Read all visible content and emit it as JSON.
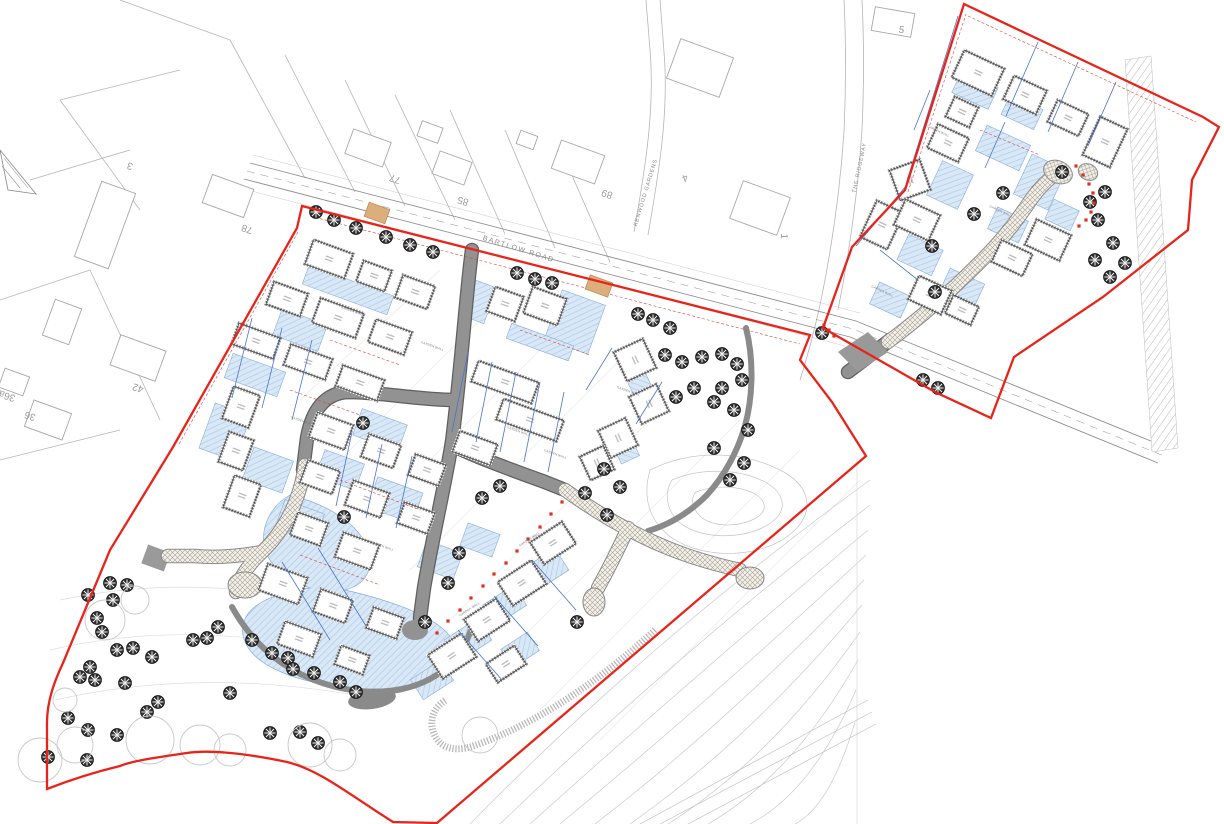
{
  "map": {
    "colors": {
      "site_boundary_red": "#e8231a",
      "inner_dash_red": "#d04545",
      "road_fill_grey": "#929292",
      "road_edge_grey": "#5f5f5f",
      "shared_surface_bg": "#f3f1ea",
      "shared_surface_hatch": "#a8a294",
      "drive_fill_blue": "#d9e8f7",
      "drive_hatch_blue": "#a9c6e6",
      "plot_line_blue": "#4a74cc",
      "building_wall_grey": "#8a8a8a",
      "context_line_grey": "#a8a8a8",
      "contour_grey": "#cacaca",
      "tree_dark": "#2e2e2e",
      "crossing_tan": "#dcae7e",
      "marker_dot_red": "#e03020"
    },
    "road_labels": [
      {
        "text": "BARTLOW ROAD",
        "x": 518,
        "y": 251,
        "rot": 17.5,
        "size": 7,
        "ls": 1.5
      },
      {
        "text": "KENWOOD GARDENS",
        "x": 647,
        "y": 193,
        "rot": -73,
        "size": 5.5,
        "ls": 0.8
      },
      {
        "text": "THE RIDGEWAY",
        "x": 861,
        "y": 168,
        "rot": -78,
        "size": 5.5,
        "ls": 0.8
      }
    ],
    "house_numbers": [
      {
        "text": "77",
        "x": 396,
        "y": 176,
        "rot": 198
      },
      {
        "text": "85",
        "x": 464,
        "y": 198,
        "rot": 198
      },
      {
        "text": "89",
        "x": 608,
        "y": 191,
        "rot": 198
      },
      {
        "text": "4",
        "x": 684,
        "y": 175,
        "rot": 160
      },
      {
        "text": "1",
        "x": 781,
        "y": 236,
        "rot": 95
      },
      {
        "text": "78",
        "x": 248,
        "y": 226,
        "rot": 198
      },
      {
        "text": "42",
        "x": 139,
        "y": 385,
        "rot": 198
      },
      {
        "text": "36a",
        "x": 8,
        "y": 393,
        "rot": 198
      },
      {
        "text": "36",
        "x": 31,
        "y": 413,
        "rot": 198
      },
      {
        "text": "5",
        "x": 901,
        "y": 33,
        "rot": 10
      },
      {
        "text": "3",
        "x": 131,
        "y": 163,
        "rot": 198
      }
    ],
    "annotation_labels": [
      {
        "text": "GARDEN WALL",
        "x": 352,
        "y": 312,
        "rot": 20
      },
      {
        "text": "GARDEN WALL",
        "x": 432,
        "y": 347,
        "rot": 20
      },
      {
        "text": "GARDEN WALL",
        "x": 518,
        "y": 432,
        "rot": 20
      },
      {
        "text": "GARDEN WALL",
        "x": 302,
        "y": 422,
        "rot": 20
      },
      {
        "text": "GARDEN WALL",
        "x": 382,
        "y": 547,
        "rot": 20
      },
      {
        "text": "GARDEN WALL",
        "x": 555,
        "y": 455,
        "rot": 20
      },
      {
        "text": "GARDEN WALL",
        "x": 938,
        "y": 132,
        "rot": 25
      },
      {
        "text": "GARDEN WALL",
        "x": 1000,
        "y": 212,
        "rot": 25
      },
      {
        "text": "GARDEN WALL",
        "x": 882,
        "y": 292,
        "rot": 25
      },
      {
        "text": "GARDEN WALL",
        "x": 628,
        "y": 392,
        "rot": 20
      },
      {
        "text": "GARDEN WALL",
        "x": 470,
        "y": 610,
        "rot": -33
      },
      {
        "text": "GARDEN WALL",
        "x": 530,
        "y": 540,
        "rot": -33
      }
    ],
    "buildings": [
      [
        329,
        259,
        42,
        26,
        20
      ],
      [
        374,
        276,
        30,
        22,
        20
      ],
      [
        415,
        292,
        34,
        24,
        20
      ],
      [
        287,
        299,
        36,
        24,
        20
      ],
      [
        338,
        318,
        46,
        26,
        20
      ],
      [
        390,
        337,
        38,
        24,
        20
      ],
      [
        256,
        341,
        44,
        22,
        20
      ],
      [
        308,
        362,
        44,
        22,
        20
      ],
      [
        360,
        383,
        44,
        22,
        20
      ],
      [
        241,
        407,
        28,
        34,
        20
      ],
      [
        236,
        451,
        26,
        32,
        20
      ],
      [
        242,
        496,
        28,
        34,
        20
      ],
      [
        331,
        431,
        38,
        26,
        20
      ],
      [
        381,
        451,
        34,
        24,
        20
      ],
      [
        427,
        470,
        32,
        22,
        20
      ],
      [
        320,
        477,
        34,
        24,
        20
      ],
      [
        367,
        499,
        38,
        26,
        20
      ],
      [
        416,
        518,
        32,
        22,
        20
      ],
      [
        309,
        529,
        32,
        24,
        20
      ],
      [
        357,
        551,
        38,
        26,
        20
      ],
      [
        283,
        584,
        42,
        28,
        20
      ],
      [
        333,
        606,
        34,
        24,
        20
      ],
      [
        385,
        623,
        32,
        22,
        20
      ],
      [
        299,
        639,
        38,
        24,
        20
      ],
      [
        352,
        660,
        30,
        20,
        20
      ],
      [
        505,
        304,
        30,
        26,
        20
      ],
      [
        545,
        306,
        36,
        28,
        20
      ],
      [
        505,
        382,
        64,
        22,
        20
      ],
      [
        530,
        420,
        64,
        22,
        20
      ],
      [
        475,
        448,
        40,
        22,
        20
      ],
      [
        635,
        360,
        32,
        32,
        65
      ],
      [
        649,
        404,
        30,
        30,
        65
      ],
      [
        618,
        438,
        30,
        30,
        65
      ],
      [
        597,
        463,
        26,
        26,
        65
      ],
      [
        553,
        543,
        38,
        26,
        -33
      ],
      [
        522,
        583,
        40,
        28,
        -33
      ],
      [
        487,
        620,
        38,
        26,
        -33
      ],
      [
        452,
        656,
        40,
        28,
        -33
      ],
      [
        506,
        664,
        34,
        22,
        -33
      ],
      [
        978,
        73,
        44,
        30,
        25
      ],
      [
        1025,
        95,
        36,
        26,
        25
      ],
      [
        1068,
        118,
        34,
        24,
        25
      ],
      [
        1105,
        142,
        30,
        42,
        25
      ],
      [
        962,
        112,
        26,
        22,
        25
      ],
      [
        948,
        143,
        34,
        26,
        25
      ],
      [
        910,
        180,
        32,
        32,
        70
      ],
      [
        882,
        225,
        30,
        40,
        25
      ],
      [
        917,
        220,
        38,
        28,
        25
      ],
      [
        1048,
        240,
        38,
        28,
        25
      ],
      [
        1012,
        258,
        34,
        24,
        25
      ],
      [
        930,
        295,
        36,
        26,
        25
      ],
      [
        962,
        310,
        28,
        20,
        25
      ]
    ],
    "context_houses": [
      [
        368,
        148,
        40,
        26,
        20
      ],
      [
        430,
        132,
        22,
        16,
        20
      ],
      [
        452,
        168,
        34,
        24,
        20
      ],
      [
        578,
        162,
        46,
        30,
        20
      ],
      [
        527,
        140,
        18,
        14,
        20
      ],
      [
        700,
        68,
        56,
        42,
        20
      ],
      [
        760,
        208,
        50,
        40,
        20
      ],
      [
        893,
        22,
        40,
        24,
        10
      ],
      [
        228,
        196,
        44,
        30,
        20
      ],
      [
        138,
        358,
        48,
        32,
        20
      ],
      [
        48,
        420,
        40,
        28,
        20
      ],
      [
        14,
        382,
        26,
        20,
        20
      ],
      [
        105,
        225,
        36,
        80,
        20
      ],
      [
        62,
        322,
        28,
        38,
        20
      ]
    ],
    "driveways": [
      [
        348,
        290,
        90,
        20,
        20
      ],
      [
        575,
        322,
        46,
        52,
        20
      ],
      [
        480,
        302,
        22,
        38,
        20
      ],
      [
        540,
        342,
        66,
        16,
        20
      ],
      [
        300,
        330,
        48,
        28,
        20
      ],
      [
        255,
        375,
        56,
        26,
        20
      ],
      [
        225,
        432,
        38,
        48,
        20
      ],
      [
        268,
        470,
        42,
        34,
        20
      ],
      [
        380,
        430,
        48,
        28,
        20
      ],
      [
        340,
        470,
        42,
        28,
        20
      ],
      [
        395,
        500,
        48,
        32,
        20
      ],
      [
        300,
        520,
        42,
        28,
        20
      ],
      [
        440,
        560,
        38,
        28,
        20
      ],
      [
        480,
        540,
        34,
        24,
        20
      ],
      [
        545,
        570,
        40,
        26,
        -33
      ],
      [
        505,
        605,
        36,
        24,
        -33
      ],
      [
        468,
        640,
        40,
        26,
        -33
      ],
      [
        432,
        680,
        36,
        24,
        -33
      ],
      [
        520,
        650,
        32,
        22,
        -33
      ],
      [
        640,
        385,
        26,
        20,
        65
      ],
      [
        625,
        448,
        26,
        20,
        65
      ],
      [
        975,
        90,
        40,
        24,
        25
      ],
      [
        1022,
        112,
        36,
        22,
        25
      ],
      [
        1003,
        148,
        48,
        28,
        25
      ],
      [
        1040,
        182,
        38,
        44,
        25
      ],
      [
        950,
        185,
        34,
        38,
        25
      ],
      [
        920,
        255,
        38,
        28,
        25
      ],
      [
        1008,
        225,
        34,
        24,
        25
      ],
      [
        1062,
        215,
        28,
        22,
        25
      ],
      [
        890,
        300,
        34,
        24,
        25
      ],
      [
        962,
        288,
        38,
        26,
        25
      ]
    ],
    "plot_lines_blue": [
      [
        468,
        352,
        452,
        432
      ],
      [
        492,
        362,
        476,
        442
      ],
      [
        516,
        372,
        500,
        452
      ],
      [
        540,
        382,
        524,
        462
      ],
      [
        564,
        392,
        548,
        472
      ],
      [
        252,
        318,
        232,
        398
      ],
      [
        282,
        328,
        262,
        408
      ],
      [
        312,
        340,
        292,
        420
      ],
      [
        352,
        432,
        336,
        506
      ],
      [
        382,
        444,
        366,
        518
      ],
      [
        412,
        456,
        396,
        528
      ],
      [
        282,
        562,
        330,
        640
      ],
      [
        318,
        548,
        366,
        626
      ],
      [
        532,
        560,
        576,
        610
      ],
      [
        494,
        596,
        538,
        646
      ],
      [
        458,
        630,
        502,
        680
      ],
      [
        612,
        348,
        586,
        390
      ],
      [
        662,
        382,
        636,
        424
      ],
      [
        958,
        16,
        906,
        184
      ],
      [
        906,
        186,
        856,
        246
      ],
      [
        1038,
        42,
        1006,
        116
      ],
      [
        1078,
        62,
        1048,
        132
      ],
      [
        1116,
        82,
        1088,
        146
      ],
      [
        930,
        90,
        914,
        130
      ],
      [
        1005,
        122,
        985,
        168
      ],
      [
        880,
        250,
        918,
        280
      ]
    ],
    "fence_lines_red": [
      [
        310,
        216,
        800,
        344
      ],
      [
        298,
        232,
        178,
        446
      ],
      [
        968,
        16,
        1196,
        122
      ],
      [
        908,
        192,
        966,
        14
      ],
      [
        330,
        340,
        400,
        365
      ],
      [
        290,
        390,
        360,
        415
      ],
      [
        340,
        480,
        420,
        510
      ],
      [
        300,
        555,
        380,
        585
      ],
      [
        520,
        330,
        590,
        355
      ],
      [
        980,
        130,
        1040,
        155
      ]
    ],
    "marker_dots_red": [
      [
        437,
        633
      ],
      [
        448,
        621
      ],
      [
        460,
        610
      ],
      [
        471,
        598
      ],
      [
        483,
        586
      ],
      [
        494,
        574
      ],
      [
        506,
        563
      ],
      [
        517,
        551
      ],
      [
        528,
        539
      ],
      [
        540,
        527
      ],
      [
        551,
        514
      ],
      [
        562,
        502
      ],
      [
        1076,
        166
      ],
      [
        1083,
        175
      ],
      [
        1089,
        184
      ],
      [
        1093,
        193
      ],
      [
        1094,
        203
      ],
      [
        1091,
        212
      ],
      [
        1086,
        220
      ],
      [
        1079,
        226
      ],
      [
        824,
        325
      ],
      [
        829,
        330
      ],
      [
        834,
        336
      ]
    ],
    "trees_dark": [
      [
        316,
        212
      ],
      [
        334,
        220
      ],
      [
        356,
        228
      ],
      [
        386,
        237
      ],
      [
        410,
        245
      ],
      [
        433,
        252
      ],
      [
        517,
        273
      ],
      [
        535,
        279
      ],
      [
        552,
        283
      ],
      [
        638,
        314
      ],
      [
        653,
        320
      ],
      [
        670,
        328
      ],
      [
        665,
        355
      ],
      [
        682,
        362
      ],
      [
        702,
        357
      ],
      [
        722,
        354
      ],
      [
        737,
        364
      ],
      [
        742,
        380
      ],
      [
        722,
        388
      ],
      [
        694,
        388
      ],
      [
        676,
        397
      ],
      [
        714,
        402
      ],
      [
        734,
        410
      ],
      [
        748,
        430
      ],
      [
        714,
        448
      ],
      [
        744,
        463
      ],
      [
        730,
        480
      ],
      [
        363,
        423
      ],
      [
        344,
        517
      ],
      [
        459,
        553
      ],
      [
        482,
        498
      ],
      [
        500,
        486
      ],
      [
        604,
        469
      ],
      [
        620,
        487
      ],
      [
        585,
        493
      ],
      [
        607,
        515
      ],
      [
        448,
        583
      ],
      [
        425,
        622
      ],
      [
        577,
        622
      ],
      [
        252,
        640
      ],
      [
        272,
        653
      ],
      [
        288,
        658
      ],
      [
        293,
        669
      ],
      [
        314,
        673
      ],
      [
        340,
        682
      ],
      [
        356,
        692
      ],
      [
        110,
        583
      ],
      [
        127,
        585
      ],
      [
        88,
        595
      ],
      [
        113,
        600
      ],
      [
        97,
        618
      ],
      [
        102,
        632
      ],
      [
        117,
        650
      ],
      [
        133,
        648
      ],
      [
        152,
        657
      ],
      [
        90,
        667
      ],
      [
        80,
        677
      ],
      [
        95,
        680
      ],
      [
        125,
        683
      ],
      [
        158,
        702
      ],
      [
        147,
        712
      ],
      [
        68,
        718
      ],
      [
        88,
        730
      ],
      [
        117,
        735
      ],
      [
        48,
        757
      ],
      [
        87,
        760
      ],
      [
        193,
        640
      ],
      [
        207,
        638
      ],
      [
        218,
        627
      ],
      [
        230,
        693
      ],
      [
        300,
        732
      ],
      [
        318,
        743
      ],
      [
        270,
        733
      ],
      [
        822,
        333
      ],
      [
        923,
        380
      ],
      [
        938,
        388
      ],
      [
        935,
        292
      ],
      [
        1003,
        193
      ],
      [
        974,
        214
      ],
      [
        932,
        246
      ],
      [
        1062,
        172
      ],
      [
        1105,
        192
      ],
      [
        1090,
        202
      ],
      [
        1098,
        220
      ],
      [
        1113,
        243
      ],
      [
        1095,
        260
      ],
      [
        1125,
        263
      ],
      [
        1110,
        277
      ]
    ],
    "trees_canopy": [
      [
        40,
        760,
        22
      ],
      [
        75,
        745,
        18
      ],
      [
        105,
        620,
        20
      ],
      [
        150,
        740,
        24
      ],
      [
        200,
        745,
        20
      ],
      [
        230,
        750,
        16
      ],
      [
        310,
        745,
        22
      ],
      [
        340,
        755,
        16
      ],
      [
        135,
        600,
        14
      ],
      [
        65,
        700,
        12
      ],
      [
        480,
        735,
        18
      ]
    ]
  }
}
